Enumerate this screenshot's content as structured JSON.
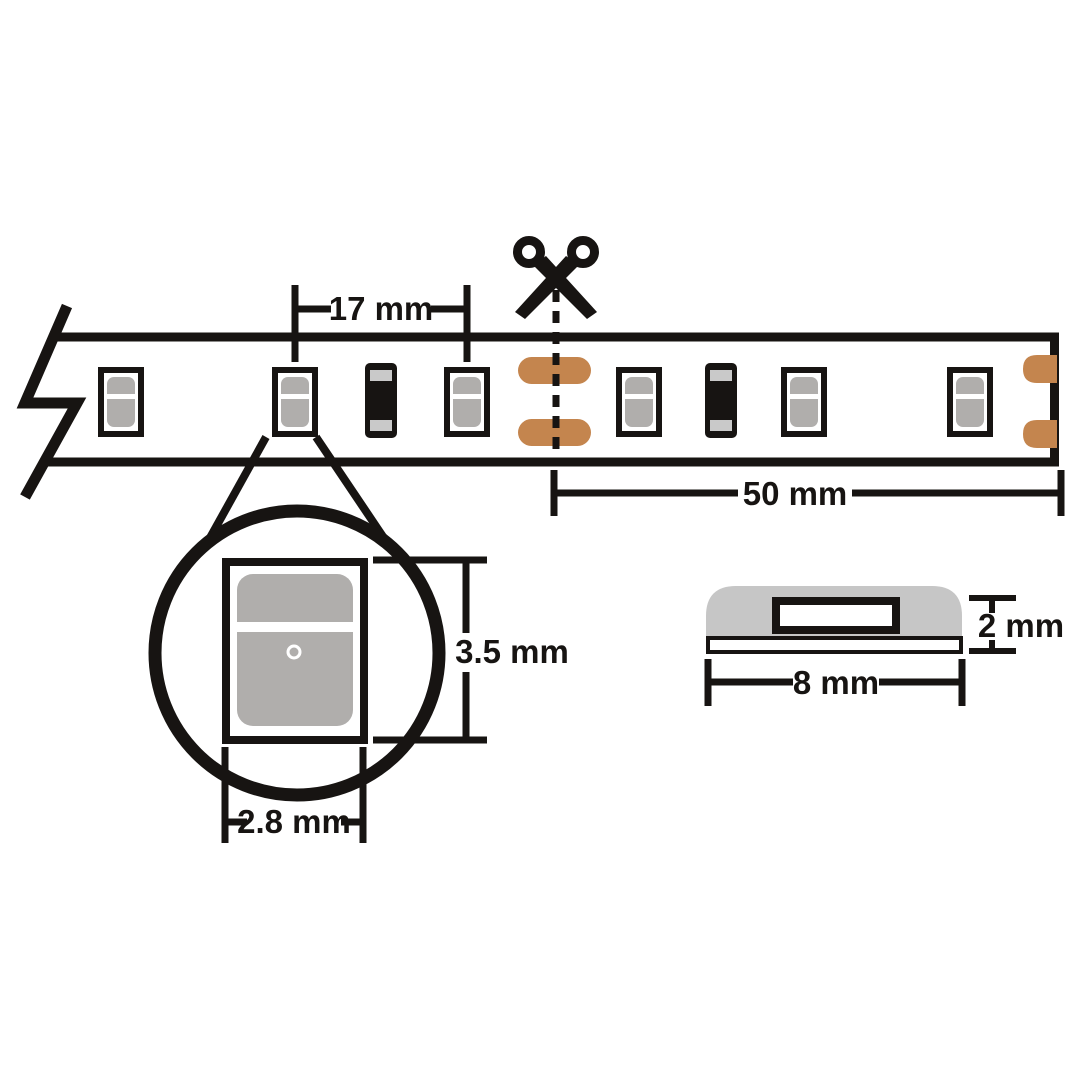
{
  "labels": {
    "led_pitch": "17 mm",
    "cut_increment": "50 mm",
    "led_package_height": "3.5 mm",
    "led_package_width": "2.8 mm",
    "strip_thickness": "2 mm",
    "strip_width": "8 mm"
  },
  "icons": {
    "scissors": "cut-here-scissors",
    "break_symbol": "strip-continues-zigzag",
    "magnifier": "detail-callout-circle"
  },
  "colors": {
    "ink": "#171412",
    "white": "#ffffff",
    "led_gray": "#b0aeac",
    "band_gray": "#c9c9c9",
    "copper": "#c4854e",
    "profile_gray": "#c6c6c6"
  }
}
